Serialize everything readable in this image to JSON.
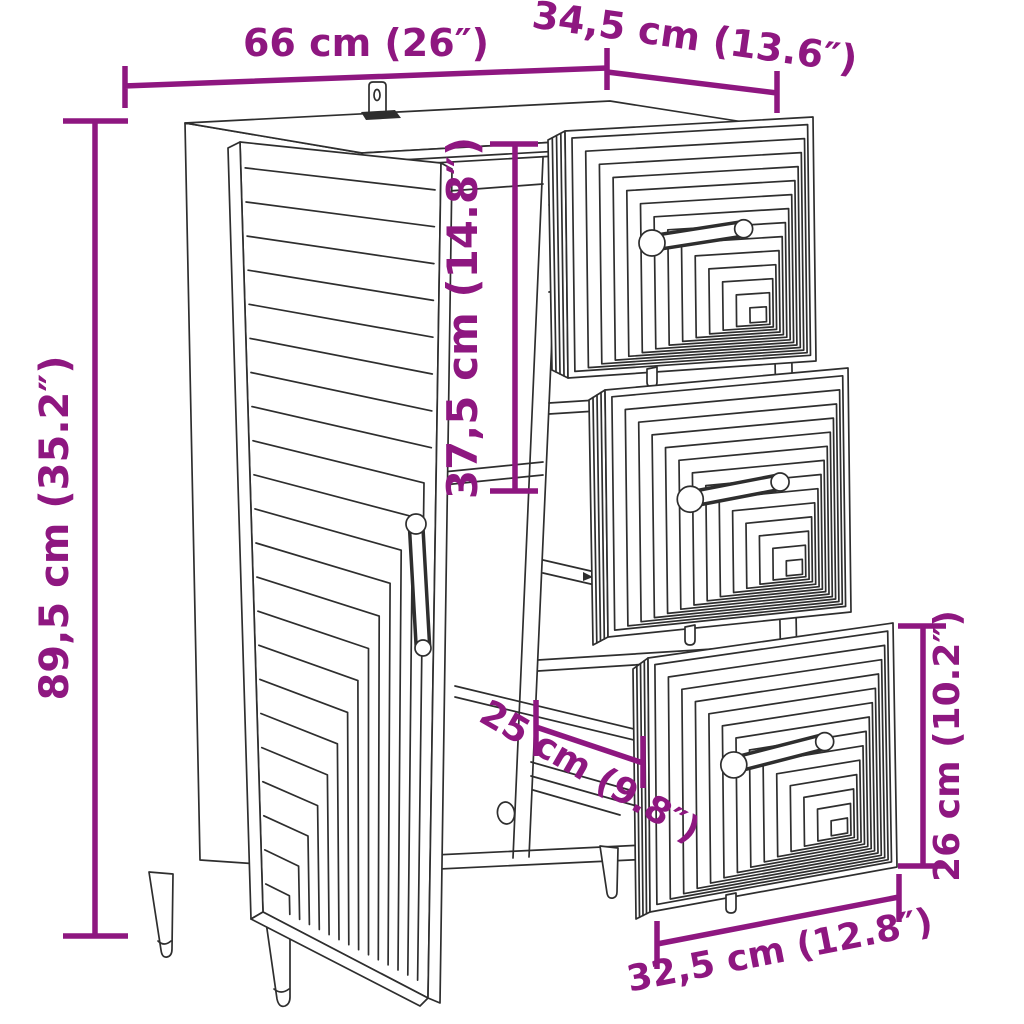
{
  "title": "Sideboard with open door and three pulled-out drawers - dimension diagram",
  "colors": {
    "dimension": "#8E1780",
    "line": "#2E2E2E",
    "background": "#FFFFFF"
  },
  "dimensions": {
    "width": {
      "cm": "66",
      "inches": "26",
      "label": "66 cm (26″)"
    },
    "depth": {
      "cm": "34,5",
      "inches": "13.6",
      "label": "34,5 cm (13.6″)"
    },
    "height": {
      "cm": "89,5",
      "inches": "35.2",
      "label": "89,5 cm (35.2″)"
    },
    "upper_inner_height": {
      "cm": "37,5",
      "inches": "14.8",
      "label": "37,5 cm (14.8″)"
    },
    "drawer_front_height": {
      "cm": "26",
      "inches": "10.2",
      "label": "26 cm (10.2″)"
    },
    "inner_depth": {
      "cm": "25",
      "inches": "9.8",
      "label": "25 cm (9.8″)"
    },
    "drawer_front_width": {
      "cm": "32,5",
      "inches": "12.8",
      "label": "32,5 cm (12.8″)"
    }
  }
}
